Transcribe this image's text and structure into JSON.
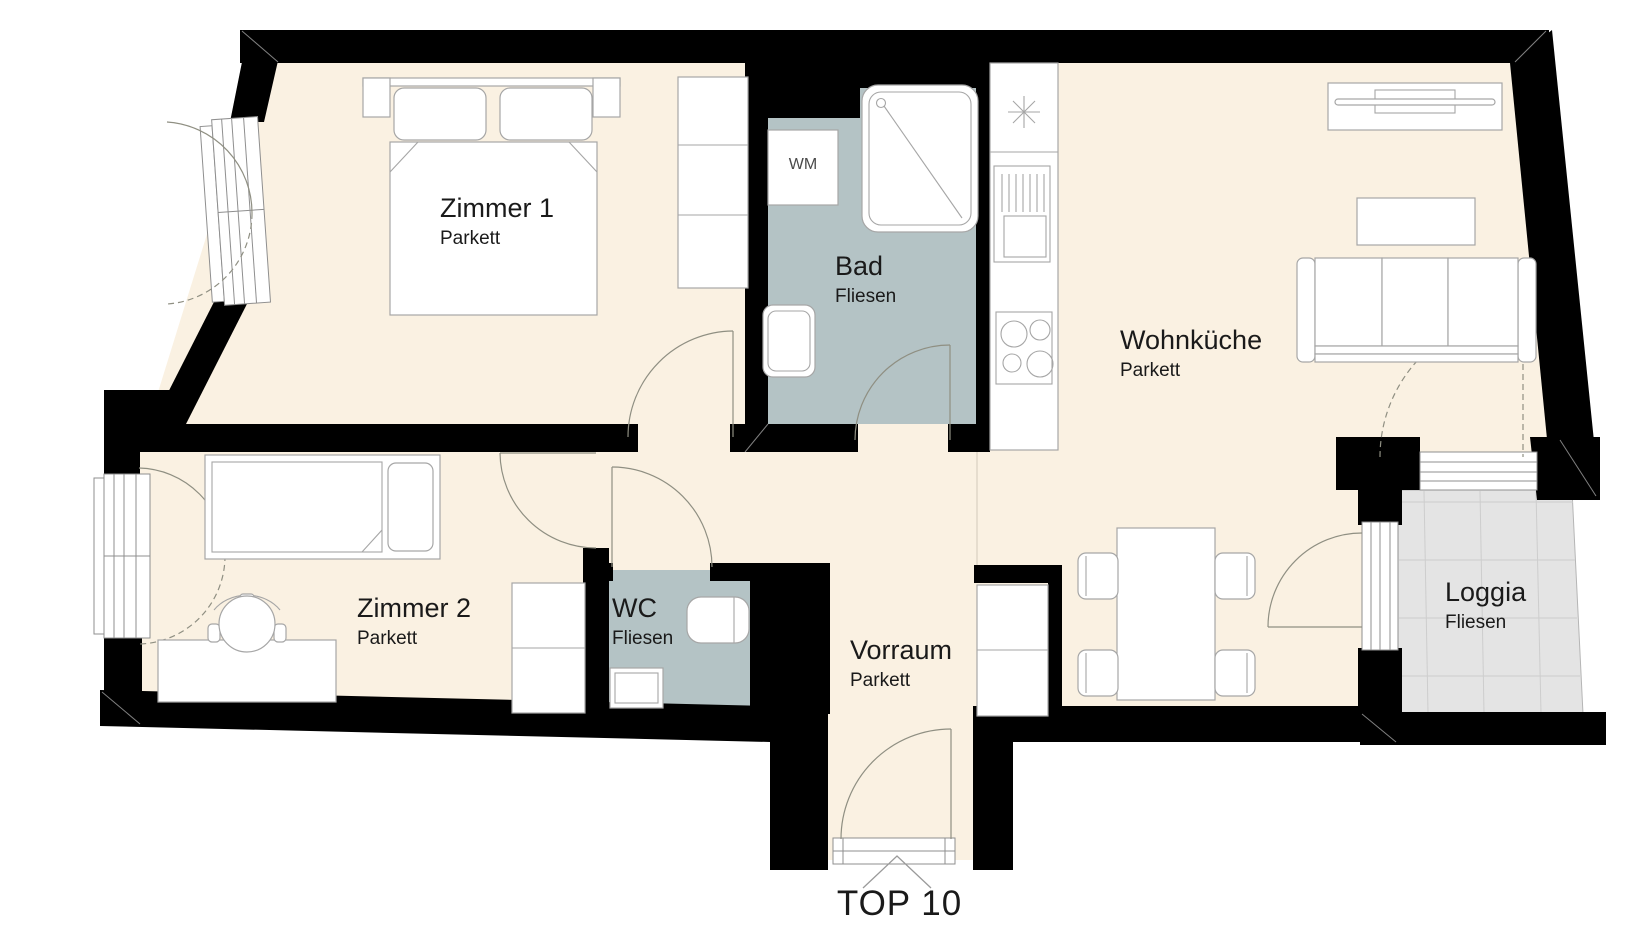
{
  "plan_title": "TOP 10",
  "entrance": {
    "unit_label": "TOP 10"
  },
  "rooms": {
    "zimmer1": {
      "name": "Zimmer 1",
      "floor": "Parkett"
    },
    "bad": {
      "name": "Bad",
      "floor": "Fliesen"
    },
    "wohnkueche": {
      "name": "Wohnküche",
      "floor": "Parkett"
    },
    "zimmer2": {
      "name": "Zimmer 2",
      "floor": "Parkett"
    },
    "wc": {
      "name": "WC",
      "floor": "Fliesen"
    },
    "vorraum": {
      "name": "Vorraum",
      "floor": "Parkett"
    },
    "loggia": {
      "name": "Loggia",
      "floor": "Fliesen"
    }
  },
  "appliances": {
    "washing_machine": "WM"
  },
  "colors": {
    "wall": "#000000",
    "parquet": "#faf1e2",
    "tile": "#b4c3c5",
    "loggia_tile": "#e4e4e4",
    "label": "#1a1a1a"
  }
}
